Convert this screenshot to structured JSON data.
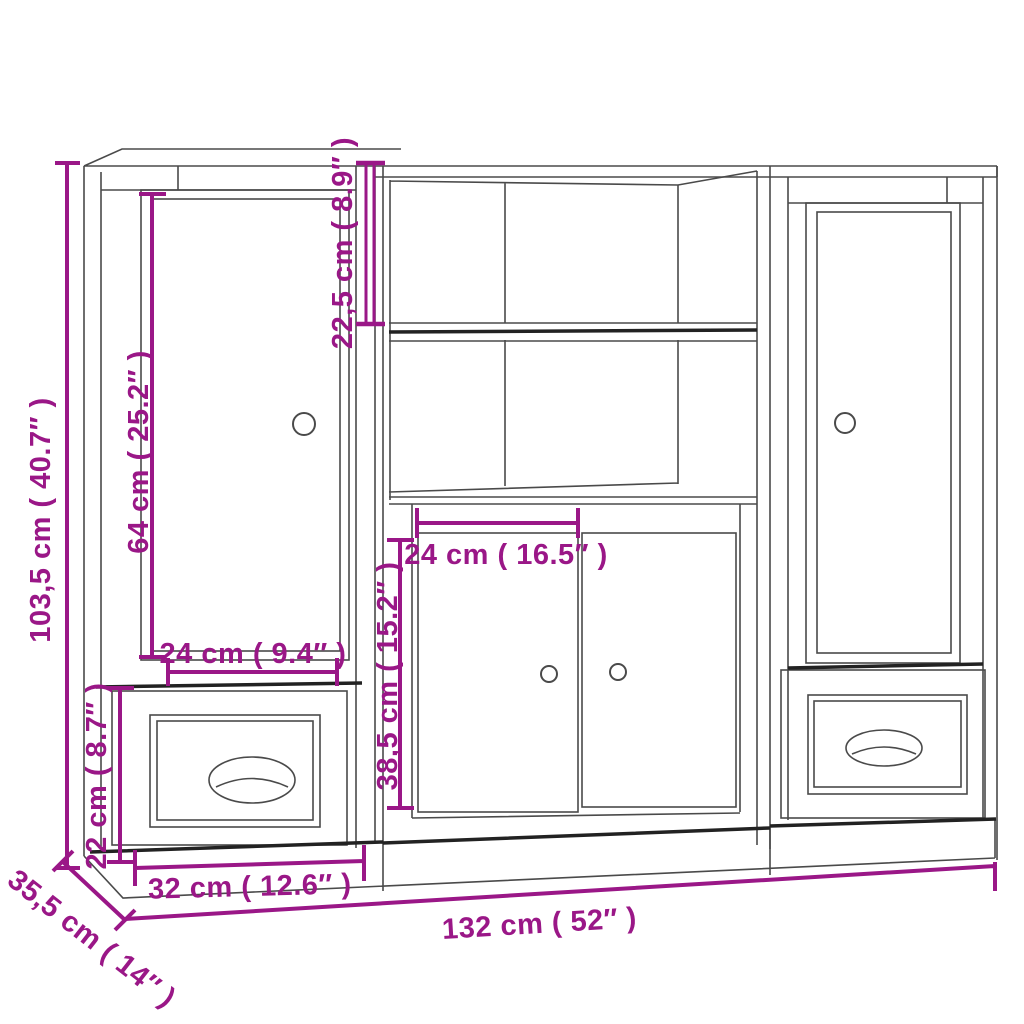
{
  "diagram": {
    "type": "furniture-dimension-diagram",
    "subject": "3-piece highboard set: two side cabinets with door and drawer, center unit with open shelves and double doors",
    "background_color": "#ffffff",
    "outline_color": "#4a4a4a",
    "shadow_line_color": "#222222",
    "accent_color": "#9A1787",
    "dimensions": {
      "overall_height": "103,5 cm ( 40.7″ )",
      "side_door_height": "64 cm ( 25.2″ )",
      "top_compartment_height": "22,5 cm ( 8.9″ )",
      "side_door_width": "24 cm ( 9.4″ )",
      "center_door_width": "24 cm ( 16.5″ )",
      "center_door_height": "38,5 cm ( 15.2″ )",
      "drawer_height": "22 cm ( 8.7″ )",
      "drawer_width": "32 cm ( 12.6″ )",
      "overall_width": "132 cm ( 52″ )",
      "overall_depth": "35,5 cm ( 14″ )"
    }
  }
}
